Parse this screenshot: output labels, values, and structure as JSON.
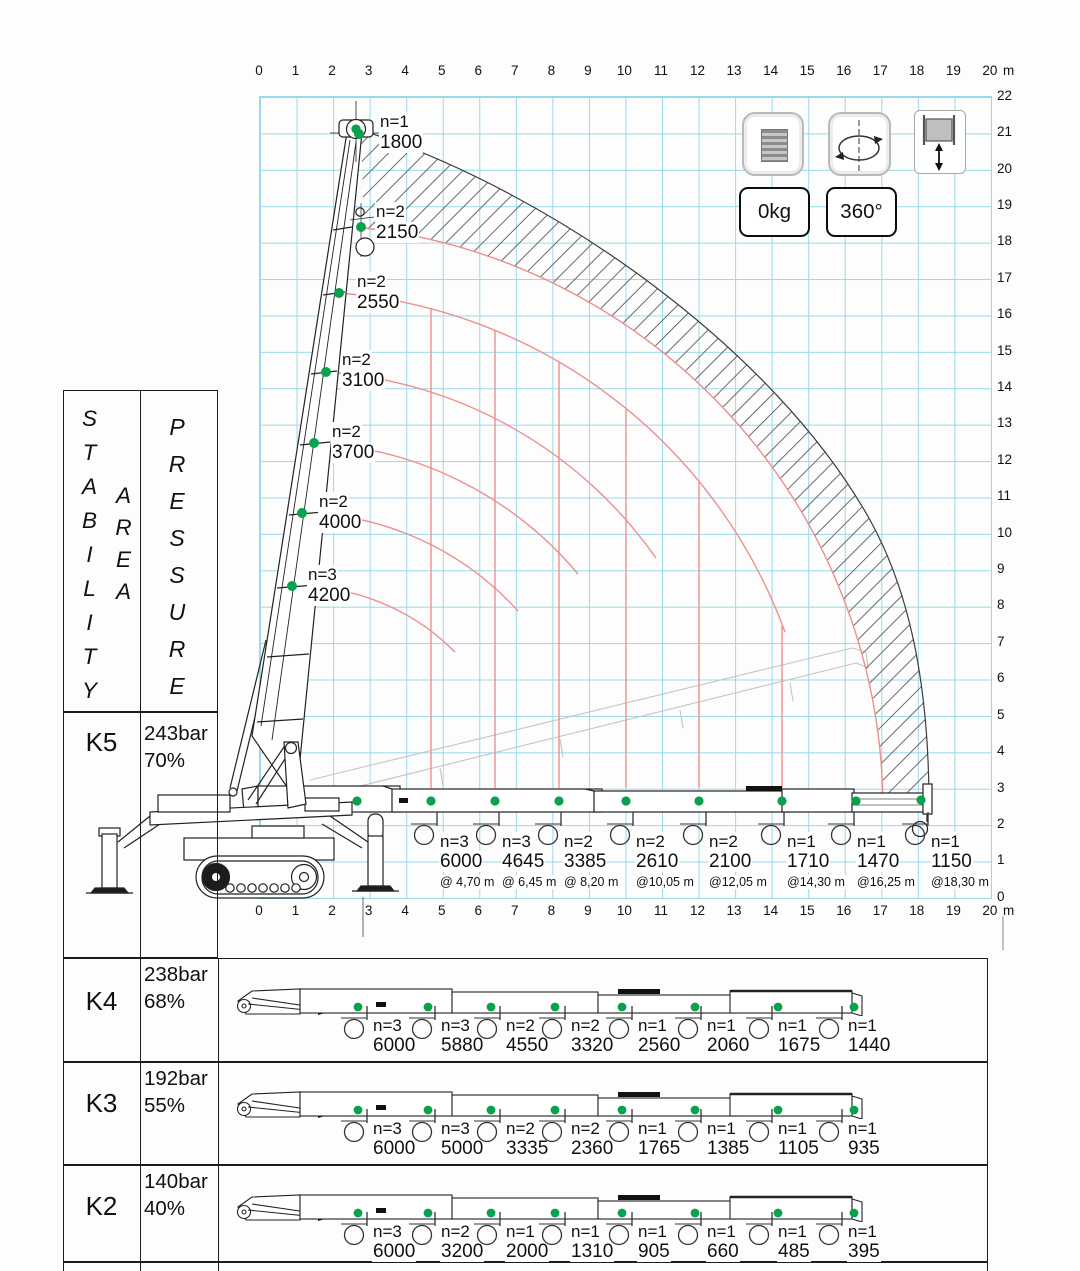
{
  "axes": {
    "unit": "m",
    "top": [
      "0",
      "1",
      "2",
      "3",
      "4",
      "5",
      "6",
      "7",
      "8",
      "9",
      "10",
      "11",
      "12",
      "13",
      "14",
      "15",
      "16",
      "17",
      "18",
      "19",
      "20"
    ],
    "bottom": [
      "0",
      "1",
      "2",
      "3",
      "4",
      "5",
      "6",
      "7",
      "8",
      "9",
      "10",
      "11",
      "12",
      "13",
      "14",
      "15",
      "16",
      "17",
      "18",
      "19",
      "20"
    ],
    "right": [
      "22",
      "21",
      "20",
      "19",
      "18",
      "17",
      "16",
      "15",
      "14",
      "13",
      "12",
      "11",
      "10",
      "9",
      "8",
      "7",
      "6",
      "5",
      "4",
      "3",
      "2",
      "1",
      "0"
    ]
  },
  "controls": {
    "counterweight_label": "0kg",
    "slew_label": "360°",
    "icons": {
      "counterweight": "counterweight-stack-icon",
      "slew": "slew-rotation-icon",
      "winch": "winch-hook-icon"
    }
  },
  "chart": {
    "boom_points": [
      {
        "n": "n=1",
        "load": "1800"
      },
      {
        "n": "n=2",
        "load": "2150"
      },
      {
        "n": "n=2",
        "load": "2550"
      },
      {
        "n": "n=2",
        "load": "3100"
      },
      {
        "n": "n=2",
        "load": "3700"
      },
      {
        "n": "n=2",
        "load": "4000"
      },
      {
        "n": "n=3",
        "load": "4200"
      }
    ],
    "radius_points": [
      {
        "n": "n=3",
        "load": "6000",
        "radius": "@ 4,70 m"
      },
      {
        "n": "n=3",
        "load": "4645",
        "radius": "@ 6,45 m"
      },
      {
        "n": "n=2",
        "load": "3385",
        "radius": "@ 8,20 m"
      },
      {
        "n": "n=2",
        "load": "2610",
        "radius": "@10,05 m"
      },
      {
        "n": "n=2",
        "load": "2100",
        "radius": "@12,05 m"
      },
      {
        "n": "n=1",
        "load": "1710",
        "radius": "@14,30 m"
      },
      {
        "n": "n=1",
        "load": "1470",
        "radius": "@16,25 m"
      },
      {
        "n": "n=1",
        "load": "1150",
        "radius": "@18,30 m"
      }
    ]
  },
  "table": {
    "col1_header": "STABILITY",
    "col1_header2": "AREA",
    "col2_header": "PRESSURE",
    "rows": [
      {
        "key": "K5",
        "pressure": "243bar",
        "percent": "70%",
        "loads": []
      },
      {
        "key": "K4",
        "pressure": "238bar",
        "percent": "68%",
        "loads": [
          {
            "n": "n=3",
            "load": "6000"
          },
          {
            "n": "n=3",
            "load": "5880"
          },
          {
            "n": "n=2",
            "load": "4550"
          },
          {
            "n": "n=2",
            "load": "3320"
          },
          {
            "n": "n=1",
            "load": "2560"
          },
          {
            "n": "n=1",
            "load": "2060"
          },
          {
            "n": "n=1",
            "load": "1675"
          },
          {
            "n": "n=1",
            "load": "1440"
          }
        ]
      },
      {
        "key": "K3",
        "pressure": "192bar",
        "percent": "55%",
        "loads": [
          {
            "n": "n=3",
            "load": "6000"
          },
          {
            "n": "n=3",
            "load": "5000"
          },
          {
            "n": "n=2",
            "load": "3335"
          },
          {
            "n": "n=2",
            "load": "2360"
          },
          {
            "n": "n=1",
            "load": "1765"
          },
          {
            "n": "n=1",
            "load": "1385"
          },
          {
            "n": "n=1",
            "load": "1105"
          },
          {
            "n": "n=1",
            "load": "935"
          }
        ]
      },
      {
        "key": "K2",
        "pressure": "140bar",
        "percent": "40%",
        "loads": [
          {
            "n": "n=3",
            "load": "6000"
          },
          {
            "n": "n=2",
            "load": "3200"
          },
          {
            "n": "n=1",
            "load": "2000"
          },
          {
            "n": "n=1",
            "load": "1310"
          },
          {
            "n": "n=1",
            "load": "905"
          },
          {
            "n": "n=1",
            "load": "660"
          },
          {
            "n": "n=1",
            "load": "485"
          },
          {
            "n": "n=1",
            "load": "395"
          }
        ]
      }
    ]
  },
  "colors": {
    "grid": "#99d9eb",
    "capacity_arc": "#ee8f8c",
    "load_marker": "#0aa14e"
  }
}
